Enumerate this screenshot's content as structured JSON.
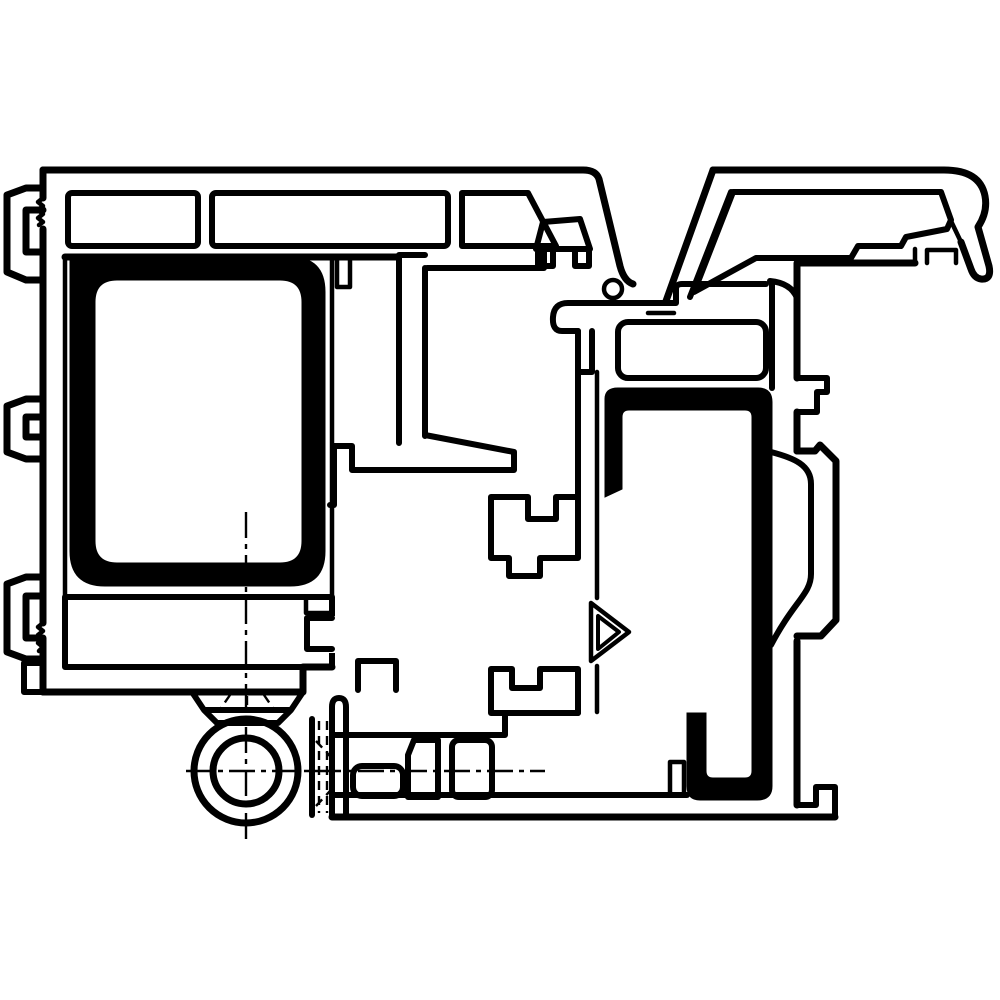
{
  "canvas": {
    "width": 1000,
    "height": 1000,
    "background": "#ffffff"
  },
  "drawing": {
    "type": "technical-cross-section",
    "subject": "window-door-profile-section-with-hinge",
    "line_color": "#000000",
    "fill_black": "#000000",
    "background": "#ffffff",
    "stroke_main": 7,
    "stroke_medium": 6,
    "stroke_thin": 4.5,
    "stroke_hair": 2.4,
    "centerline_dash": "26 6 5 6",
    "hidden_dash": "9 6",
    "hinge": {
      "cx": 246,
      "cy": 771,
      "r_outer": 52,
      "r_inner": 33
    },
    "seal_bulb": {
      "cx": 613,
      "cy": 289,
      "r": 9
    },
    "components": [
      "frame-left-profile",
      "wall-anchor-top",
      "wall-anchor-middle",
      "wall-anchor-bottom",
      "top-beam-chambers",
      "steel-reinforcement-left",
      "sash-profile",
      "glazing-bead",
      "euro-groove-blocks",
      "seal-contact-marker",
      "steel-reinforcement-right",
      "frame-right-profile",
      "overhang-cladding-profile",
      "hinge-barrel",
      "screw-washer",
      "hidden-hinge-arm",
      "centerlines"
    ]
  }
}
